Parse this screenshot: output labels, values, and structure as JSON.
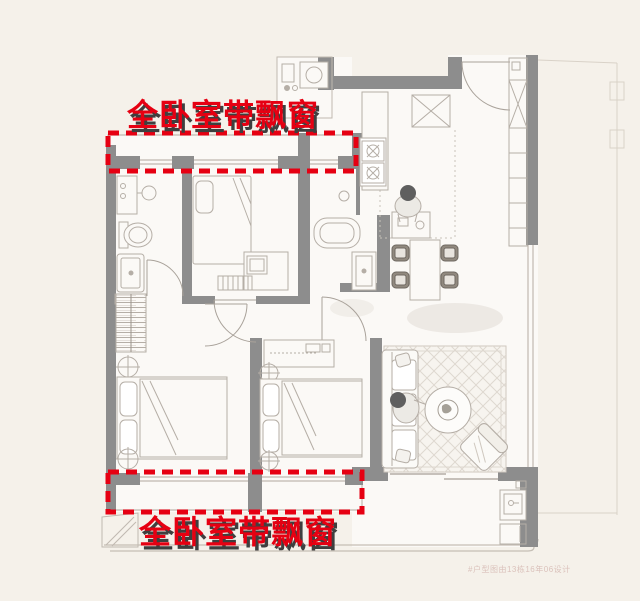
{
  "annotations": {
    "top": {
      "text": "全卧室带飘窗",
      "color": "#e60012"
    },
    "bottom": {
      "text": "全卧室带飘窗",
      "color": "#e60012"
    }
  },
  "watermark": {
    "text": "#户型图由13栋16年06设计"
  },
  "colors": {
    "background": "#f5f1ea",
    "room_fill": "#fbf9f6",
    "wall_gray": "#8d8d8d",
    "furniture_line": "#b5aea6",
    "window_line": "#c0b9b0",
    "annotation_red": "#e60012",
    "annotation_shadow": "#3f3f3f"
  },
  "highlight_boxes": [
    {
      "name": "top-bay-window-highlight",
      "style": "red dashed rectangle"
    },
    {
      "name": "bottom-bay-window-highlight",
      "style": "red dashed rectangle"
    }
  ],
  "furniture": [
    "bathroom-sink",
    "toilet",
    "shower",
    "wardrobe",
    "bed",
    "desk",
    "washing-machine",
    "stove",
    "kitchen-counter",
    "dining-table",
    "dining-chair",
    "shoe-cabinet",
    "sofa",
    "coffee-table",
    "plant",
    "armchair",
    "rug",
    "balcony-sink",
    "dresser",
    "person",
    "ac-platform"
  ]
}
